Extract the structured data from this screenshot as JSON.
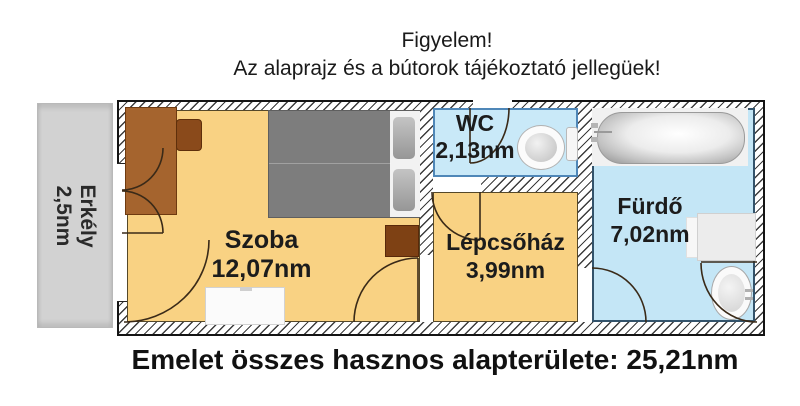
{
  "notice": {
    "line1": "Figyelem!",
    "line2": "Az alaprajz és a bútorok tájékoztató jellegüek!"
  },
  "rooms": {
    "balcony": {
      "name": "Erkély",
      "area": "2,5nm"
    },
    "bedroom": {
      "name": "Szoba",
      "area": "12,07nm"
    },
    "wc": {
      "name": "WC",
      "area": "2,13nm"
    },
    "staircase": {
      "name": "Lépcsőház",
      "area": "3,99nm"
    },
    "bathroom": {
      "name": "Fürdő",
      "area": "7,02nm"
    }
  },
  "caption": {
    "total": "Emelet összes hasznos alapterülete: 25,21nm"
  },
  "fixtures": {
    "bedroom": [
      "wardrobe",
      "chair",
      "double-bed",
      "nightstand",
      "dresser"
    ],
    "wc": [
      "toilet"
    ],
    "bathroom": [
      "bathtub",
      "washing-machine",
      "sink"
    ]
  },
  "colors": {
    "floor_warm": "#f9d283",
    "floor_wet_wc": "#c9e9f8",
    "floor_wet_bath": "#c4e6f6",
    "balcony_gray": "#d2d2d2",
    "wall_line": "#141414",
    "wood": "#a5642e",
    "wood_dark": "#7e4114",
    "bed_gray": "#7d7d7d",
    "text": "#1c1c1c"
  }
}
